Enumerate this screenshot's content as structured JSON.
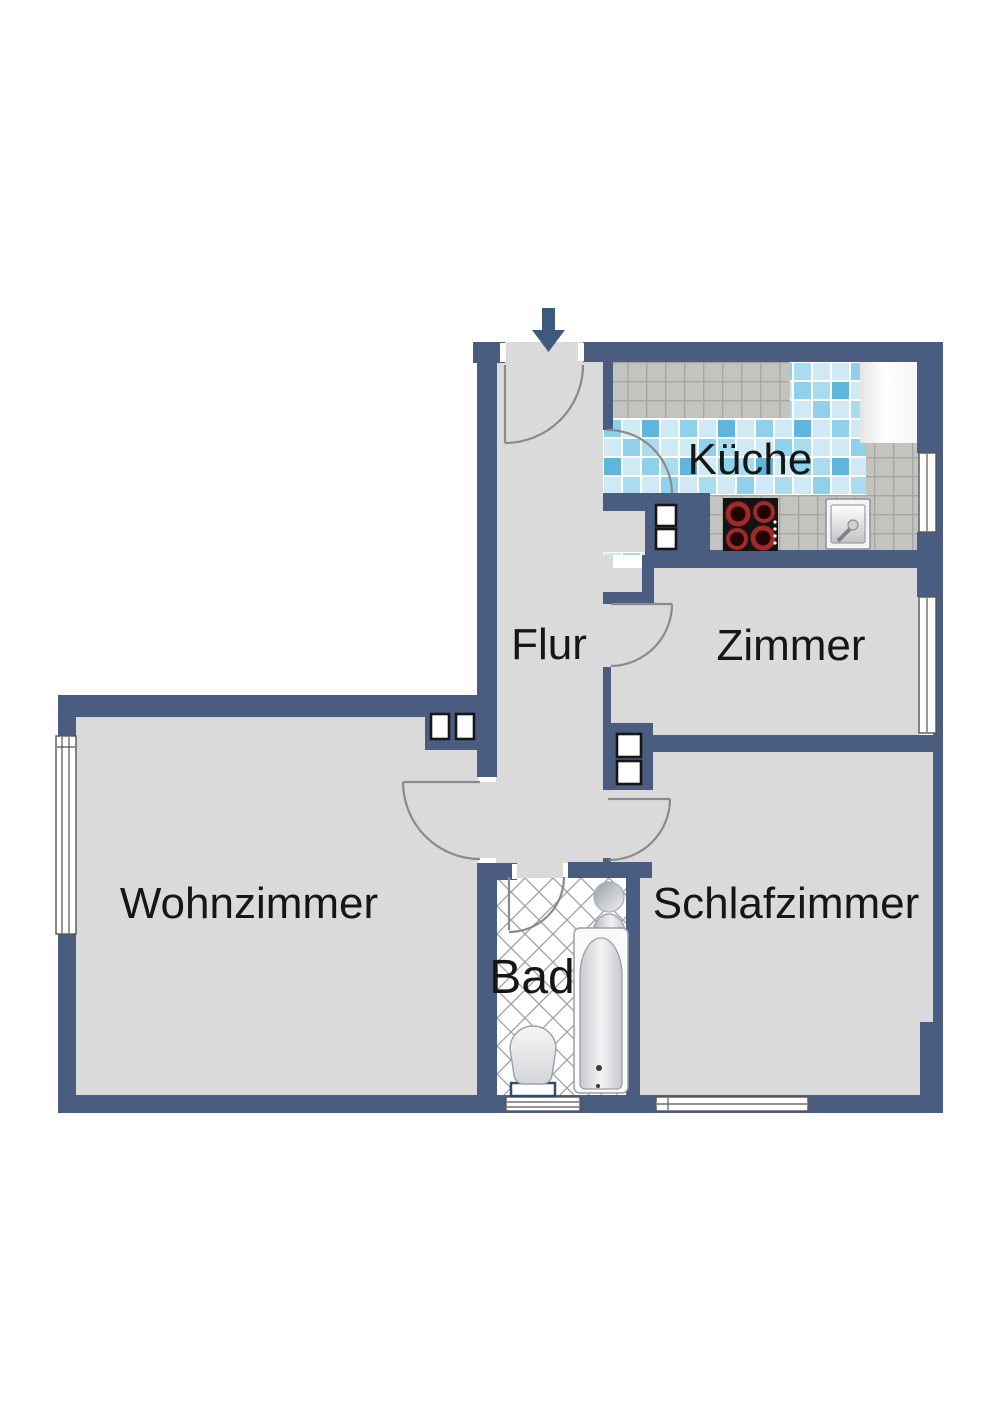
{
  "plan": {
    "rooms": [
      {
        "id": "kueche",
        "label": "Küche"
      },
      {
        "id": "flur",
        "label": "Flur"
      },
      {
        "id": "zimmer",
        "label": "Zimmer"
      },
      {
        "id": "wohnzimmer",
        "label": "Wohnzimmer"
      },
      {
        "id": "schlafzimmer",
        "label": "Schlafzimmer"
      },
      {
        "id": "bad",
        "label": "Bad"
      }
    ],
    "fixtures": [
      {
        "name": "entrance-arrow-icon"
      },
      {
        "name": "stove"
      },
      {
        "name": "kitchen-sink"
      },
      {
        "name": "refrigerator"
      },
      {
        "name": "kitchen-counter"
      },
      {
        "name": "bathtub"
      },
      {
        "name": "washbasin"
      },
      {
        "name": "mirror"
      },
      {
        "name": "toilet"
      }
    ]
  },
  "colors": {
    "wall": "#4a5d80",
    "floor": "#dadada",
    "bad_floor": "#ffffff",
    "counter_tile": "#c3c4bd",
    "grout": "#a3a8a0",
    "tile_blue_1": "#cfe9f5",
    "tile_blue_2": "#8fd0ea",
    "tile_blue_3": "#5fb6dc",
    "tile_blue_4": "#aadcf0",
    "label": "#161616",
    "door": "#8a8a8a",
    "window_frame": "#555555",
    "arrow": "#3d5a7e",
    "burner_ring": "#a32828"
  }
}
